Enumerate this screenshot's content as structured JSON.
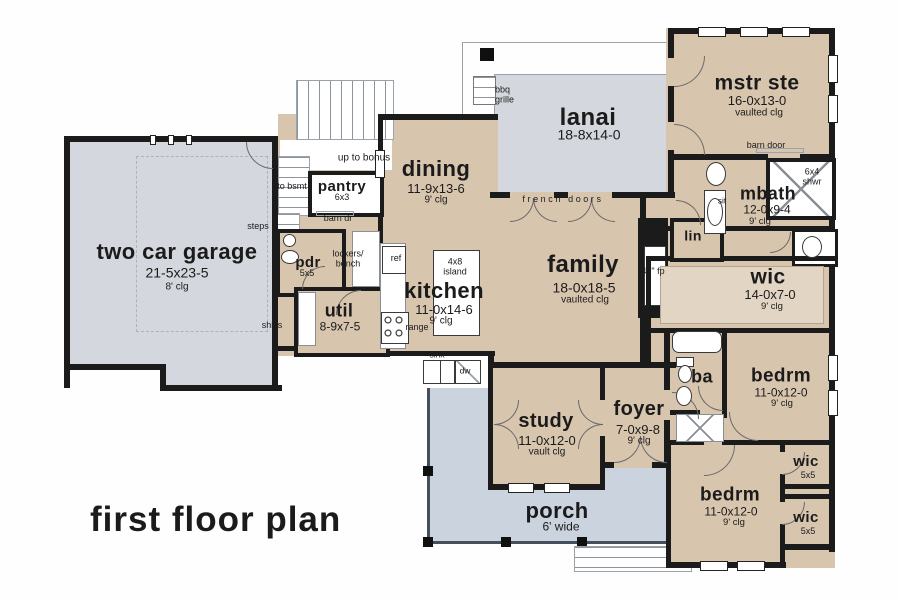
{
  "title": "first floor plan",
  "colors": {
    "room_fill": "#d8c5ae",
    "outdoor_gray": "#d4d7dd",
    "porch_gray": "#cbd3de",
    "wall": "#1b1b1b"
  },
  "rooms": {
    "garage": {
      "name": "two car garage",
      "dims": "21-5x23-5",
      "clg": "8' clg"
    },
    "dining": {
      "name": "dining",
      "dims": "11-9x13-6",
      "clg": "9' clg"
    },
    "kitchen": {
      "name": "kitchen",
      "dims": "11-0x14-6",
      "clg": "9' clg"
    },
    "family": {
      "name": "family",
      "dims": "18-0x18-5",
      "clg": "vaulted clg"
    },
    "lanai": {
      "name": "lanai",
      "dims": "18-8x14-0"
    },
    "mstr": {
      "name": "mstr ste",
      "dims": "16-0x13-0",
      "clg": "vaulted clg"
    },
    "mbath": {
      "name": "mbath",
      "dims": "12-0x9-4",
      "clg": "9' clg"
    },
    "wic_master": {
      "name": "wic",
      "dims": "14-0x7-0",
      "clg": "9' clg"
    },
    "bedrm1": {
      "name": "bedrm",
      "dims": "11-0x12-0",
      "clg": "9' clg"
    },
    "bedrm2": {
      "name": "bedrm",
      "dims": "11-0x12-0",
      "clg": "9' clg"
    },
    "wic1": {
      "name": "wic",
      "dims": "5x5"
    },
    "wic2": {
      "name": "wic",
      "dims": "5x5"
    },
    "study": {
      "name": "study",
      "dims": "11-0x12-0",
      "clg": "vault clg"
    },
    "foyer": {
      "name": "foyer",
      "dims": "7-0x9-8",
      "clg": "9' clg"
    },
    "porch": {
      "name": "porch",
      "dims": "6' wide"
    },
    "util": {
      "name": "util",
      "dims": "8-9x7-5"
    },
    "pantry": {
      "name": "pantry",
      "dims": "6x3"
    },
    "pdr": {
      "name": "pdr",
      "dims": "5x5"
    },
    "ba": {
      "name": "ba"
    },
    "lin": {
      "name": "lin"
    }
  },
  "annotations": {
    "bbq_grille": "bbq grille",
    "french_doors": "french doors",
    "barn_door": "barn door",
    "barn_dr": "barn dr",
    "up_to_bonus": "up to bonus",
    "to_bsmt": "to bsmt",
    "steps": "steps",
    "shlvs": "shlvs",
    "lockers_bench": "lockers/ bench",
    "ref": "ref",
    "range": "range",
    "island": "4x8 island",
    "sink": "sink",
    "dw": "dw",
    "fireplace": "42\" fp",
    "sit": "sit",
    "shower": "6x4 shwr"
  }
}
